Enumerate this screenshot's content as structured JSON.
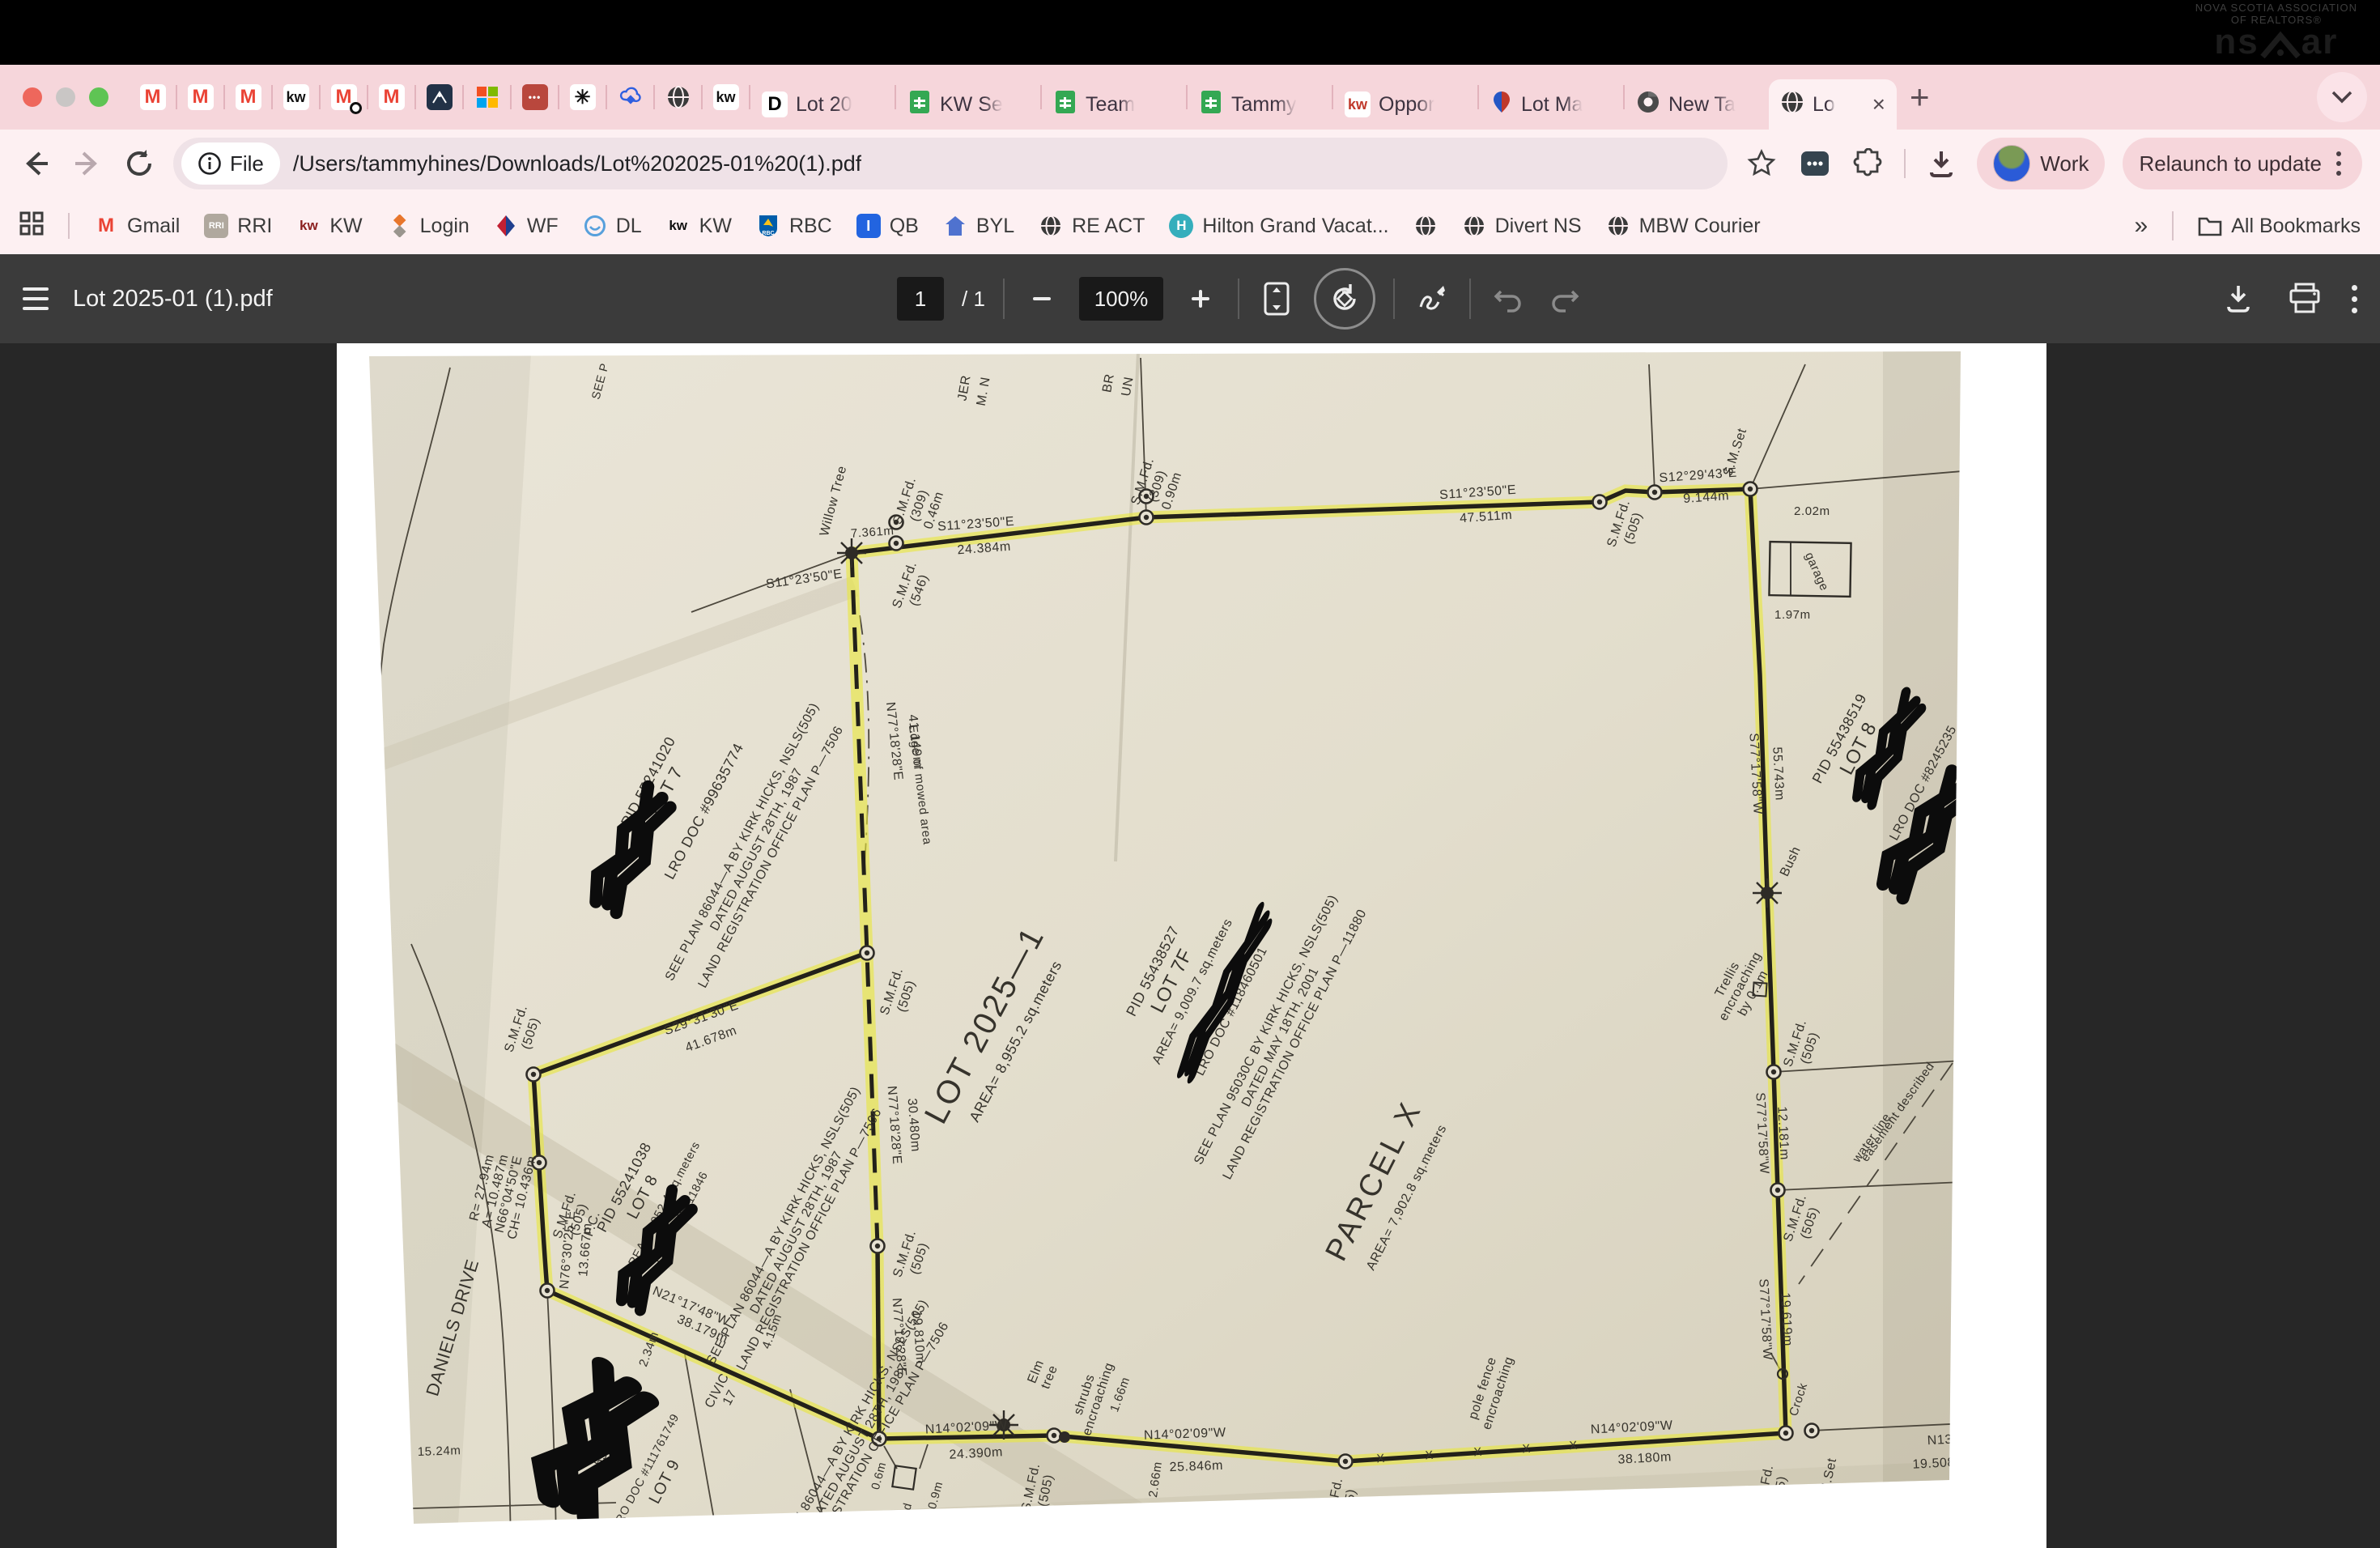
{
  "menu_logo": {
    "assoc_line1": "NOVA SCOTIA ASSOCIATION",
    "assoc_line2": "OF REALTORS®",
    "nsaar_left": "ns",
    "nsaar_right": "ar"
  },
  "ui": {
    "close": "×",
    "plus": "+",
    "overflow": "»",
    "minus": "−",
    "plus_zoom": "+",
    "undo": "↶",
    "redo": "↷"
  },
  "tab_strip": {
    "pinned": [
      {
        "glyph": "M"
      },
      {
        "glyph": "M"
      },
      {
        "glyph": "M"
      },
      {
        "glyph": "kw"
      },
      {
        "glyph": "M"
      },
      {
        "glyph": "M"
      },
      {
        "glyph": "⌃"
      },
      {
        "glyph": ""
      },
      {
        "glyph": "•••"
      },
      {
        "glyph": "✳"
      },
      {
        "glyph": ""
      },
      {
        "glyph": ""
      },
      {
        "glyph": "kw"
      }
    ],
    "tabs": [
      {
        "label": "Lot 20"
      },
      {
        "label": "KW Se"
      },
      {
        "label": "Team"
      },
      {
        "label": "Tammy"
      },
      {
        "label": "Oppor"
      },
      {
        "label": "Lot Ma"
      },
      {
        "label": "New Ta"
      },
      {
        "label": "Lo"
      }
    ]
  },
  "toolbar": {
    "file_chip": "File",
    "url": "/Users/tammyhines/Downloads/Lot%202025-01%20(1).pdf",
    "work_label": "Work",
    "relaunch_label": "Relaunch to update"
  },
  "bookmarks": {
    "items": [
      {
        "label": "Gmail"
      },
      {
        "label": "RRI"
      },
      {
        "label": "KW"
      },
      {
        "label": "Login"
      },
      {
        "label": "WF"
      },
      {
        "label": "DL"
      },
      {
        "label": "KW"
      },
      {
        "label": "RBC"
      },
      {
        "label": "QB"
      },
      {
        "label": "BYL"
      },
      {
        "label": "RE ACT"
      },
      {
        "label": "Hilton Grand Vacat..."
      },
      {
        "label": ""
      },
      {
        "label": "Divert NS"
      },
      {
        "label": "MBW Courier"
      }
    ],
    "all_bookmarks": "All Bookmarks"
  },
  "pdf_toolbar": {
    "title": "Lot 2025-01 (1).pdf",
    "page": "1",
    "slash": "/",
    "total": "1",
    "zoom": "100%"
  },
  "map_labels": {
    "willow": "Willow Tree",
    "t7361": "7.361m",
    "smfd": "S.M.Fd.",
    "n309": "(309)",
    "n505": "(505)",
    "n546": "(546)",
    "smset": "S.M.Set",
    "pc": "P.C.",
    "off046": "0.46m",
    "off090": "0.90m",
    "b_s11": "S11°23'50\"E",
    "d24384": "24.384m",
    "d47511": "47.511m",
    "b_s12": "S12°29'43\"E",
    "d9144": "9.144m",
    "g202": "2.02m",
    "g197": "1.97m",
    "garage": "garage",
    "b_s77": "S77°17'58\"W",
    "d55743": "55.743m",
    "d12181": "12.181m",
    "d19619": "19.619m",
    "bush": "Bush",
    "trellis1": "Trellis",
    "trellis2": "encroaching",
    "trellis3": "by 0.1m",
    "ease1": "easement described",
    "ease2": "water line",
    "crock": "Crock",
    "b_n13": "N13°32'10\"",
    "d19508": "19.508m",
    "b_n14": "N14°02'09\"W",
    "d38180": "38.180m",
    "d25846": "25.846m",
    "d24390": "24.390m",
    "pole1": "pole fence",
    "pole2": "encroaching",
    "g266": "2.66m",
    "g166": "1.66m",
    "shrub1": "shrubs",
    "shrub2": "encroaching",
    "elm1": "Elm",
    "elm2": "tree",
    "shed": "shed",
    "g06": "0.6m",
    "g09": "0.9m",
    "b_n21": "N21°17'48\"W",
    "d38179": "38.179m",
    "g234": "2.34m",
    "g415": "4.15m",
    "civic": "CIVIC",
    "civ17": "17",
    "daniels": "DANIELS DRIVE",
    "r1": "R= 27.94m",
    "r2": "A= 10.487m",
    "r3": "N66°04'50\"E",
    "r4": "CH= 10.436m",
    "b_n76": "N76°30'25\"E",
    "d13667": "13.667m",
    "b_s29": "S29°31'30\"E",
    "d41678": "41.678m",
    "b_n77": "N77°18'28\"E",
    "d41149": "41.149m",
    "d30480": "30.480m",
    "d19810": "19.810m",
    "mowed": "Edge of mowed area",
    "d1524": "15.24m",
    "xmark": "X",
    "lot7_pid": "PID 55241020",
    "lot7": "LOT 7",
    "lot7_doc": "LRO DOC #99635774",
    "p86a": "SEE PLAN 86044—A BY KIRK HICKS, NSLS(505)",
    "p86b": "DATED AUGUST 28TH, 1987",
    "p86c": "LAND REGISTRATION OFFICE PLAN P—7506",
    "lot8w_pid": "PID 55241038",
    "lot8w": "LOT 8",
    "lot8w_area": "AREA= 1,052.4 sq.meters",
    "lot8w_doc": "LRO DOC #11846",
    "lot9_pid": "PID 55241046",
    "lot9": "LOT 9",
    "lot9_doc": "LRO DOC #111761749",
    "lot2025": "LOT 2025—1",
    "lot2025_area": "AREA= 8,955.2 sq.meters",
    "lot7f_pid": "PID 55438527",
    "lot7f": "LOT 7F",
    "lot7f_area": "AREA= 9,009.7 sq.meters",
    "lot7f_doc": "LRO DOC #118460501",
    "p95a": "SEE PLAN 95030C BY KIRK HICKS, NSLS(505)",
    "p95b": "DATED MAY 18TH, 2001",
    "p95c": "LAND REGISTRATION OFFICE PLAN P—11880",
    "parcelx": "PARCEL X",
    "parcelx_area": "AREA= 7,902.8 sq.meters",
    "lot8e_pid": "PID 55438519",
    "lot8e": "LOT 8",
    "lot8e_doc": "LRO DOC #8245235",
    "jer": "JER",
    "mn": "M. N",
    "br": "BR",
    "un": "UN",
    "seep": "SEE P"
  }
}
